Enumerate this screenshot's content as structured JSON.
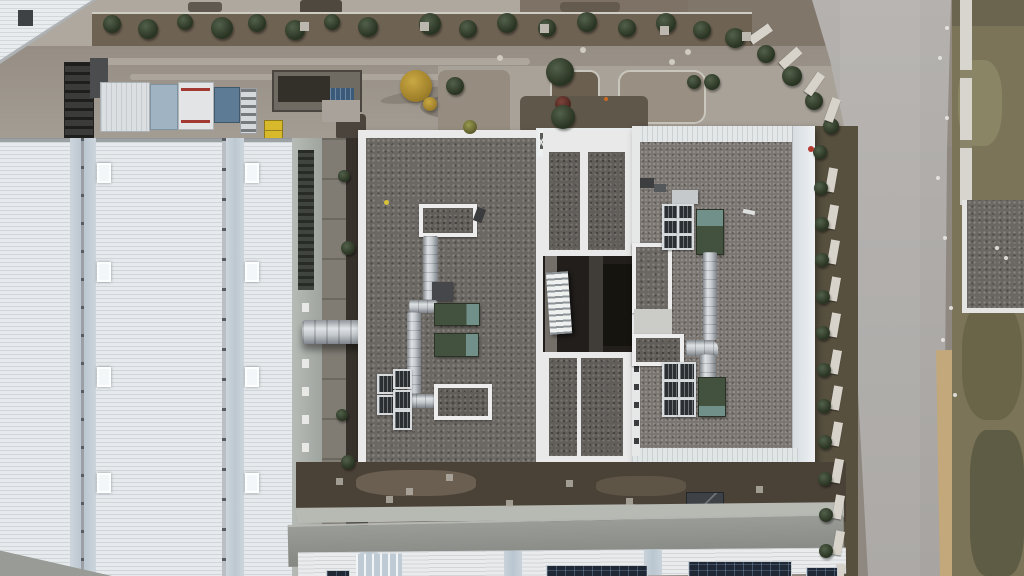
{
  "scene": {
    "type": "aerial-drone-photo",
    "subject": "industrial facility rooftops with flat gravel roof, white metal warehouse roofs, HVAC equipment, access roads",
    "palette": {
      "dirt": "#8f8881",
      "gravel": "#6b6763",
      "gravel_light": "#7b7672",
      "roof_white": "#e7eaec",
      "road": "#a8a5a2",
      "grass": "#7b7458",
      "sand": "#c3a87c",
      "green_unit": "#42523f",
      "teal_cap": "#72908a",
      "solar": "#202836",
      "yellow_tree": "#c9a843",
      "courtyard_dark": "#211e1b"
    },
    "items": [
      {
        "cls": "tree",
        "x": 112,
        "y": 24,
        "r": 9
      },
      {
        "cls": "tree",
        "x": 148,
        "y": 29,
        "r": 10
      },
      {
        "cls": "tree",
        "x": 185,
        "y": 22,
        "r": 8
      },
      {
        "cls": "tree",
        "x": 222,
        "y": 28,
        "r": 11
      },
      {
        "cls": "tree",
        "x": 257,
        "y": 23,
        "r": 9
      },
      {
        "cls": "tree",
        "x": 295,
        "y": 30,
        "r": 10
      },
      {
        "cls": "tree",
        "x": 332,
        "y": 22,
        "r": 8
      },
      {
        "cls": "tree",
        "x": 368,
        "y": 27,
        "r": 10
      },
      {
        "cls": "tree",
        "x": 430,
        "y": 24,
        "r": 11
      },
      {
        "cls": "tree",
        "x": 468,
        "y": 29,
        "r": 9
      },
      {
        "cls": "tree",
        "x": 507,
        "y": 23,
        "r": 10
      },
      {
        "cls": "tree",
        "x": 547,
        "y": 28,
        "r": 9
      },
      {
        "cls": "tree",
        "x": 587,
        "y": 22,
        "r": 10
      },
      {
        "cls": "tree",
        "x": 627,
        "y": 28,
        "r": 9
      },
      {
        "cls": "tree",
        "x": 666,
        "y": 23,
        "r": 10
      },
      {
        "cls": "tree",
        "x": 702,
        "y": 30,
        "r": 9
      },
      {
        "cls": "tree",
        "x": 735,
        "y": 38,
        "r": 10
      },
      {
        "cls": "tree",
        "x": 766,
        "y": 54,
        "r": 9
      },
      {
        "cls": "tree",
        "x": 792,
        "y": 76,
        "r": 10
      },
      {
        "cls": "tree",
        "x": 814,
        "y": 101,
        "r": 9
      },
      {
        "cls": "tree",
        "x": 831,
        "y": 126,
        "r": 8
      },
      {
        "cls": "wallseg",
        "x": 756,
        "y": 22,
        "w": 9,
        "h": 24,
        "rot": 55
      },
      {
        "cls": "wallseg",
        "x": 786,
        "y": 46,
        "w": 9,
        "h": 24,
        "rot": 48
      },
      {
        "cls": "wallseg",
        "x": 810,
        "y": 72,
        "w": 9,
        "h": 24,
        "rot": 35
      },
      {
        "cls": "wallseg",
        "x": 828,
        "y": 98,
        "w": 9,
        "h": 24,
        "rot": 20
      },
      {
        "cls": "tree",
        "x": 820,
        "y": 152,
        "r": 7
      },
      {
        "cls": "wallseg",
        "x": 827,
        "y": 168,
        "w": 9,
        "h": 24,
        "rot": 10
      },
      {
        "cls": "tree",
        "x": 821,
        "y": 188,
        "r": 7
      },
      {
        "cls": "wallseg",
        "x": 828,
        "y": 205,
        "w": 9,
        "h": 24,
        "rot": 10
      },
      {
        "cls": "tree",
        "x": 822,
        "y": 224,
        "r": 7
      },
      {
        "cls": "wallseg",
        "x": 829,
        "y": 240,
        "w": 9,
        "h": 24,
        "rot": 10
      },
      {
        "cls": "tree",
        "x": 822,
        "y": 260,
        "r": 7
      },
      {
        "cls": "wallseg",
        "x": 830,
        "y": 277,
        "w": 9,
        "h": 24,
        "rot": 10
      },
      {
        "cls": "tree",
        "x": 823,
        "y": 297,
        "r": 7
      },
      {
        "cls": "wallseg",
        "x": 830,
        "y": 313,
        "w": 9,
        "h": 24,
        "rot": 10
      },
      {
        "cls": "tree",
        "x": 823,
        "y": 333,
        "r": 7
      },
      {
        "cls": "wallseg",
        "x": 831,
        "y": 350,
        "w": 9,
        "h": 24,
        "rot": 10
      },
      {
        "cls": "tree",
        "x": 824,
        "y": 370,
        "r": 7
      },
      {
        "cls": "wallseg",
        "x": 832,
        "y": 386,
        "w": 9,
        "h": 24,
        "rot": 10
      },
      {
        "cls": "tree",
        "x": 824,
        "y": 406,
        "r": 7
      },
      {
        "cls": "wallseg",
        "x": 832,
        "y": 422,
        "w": 9,
        "h": 24,
        "rot": 10
      },
      {
        "cls": "tree",
        "x": 825,
        "y": 442,
        "r": 7
      },
      {
        "cls": "wallseg",
        "x": 833,
        "y": 459,
        "w": 9,
        "h": 24,
        "rot": 10
      },
      {
        "cls": "tree",
        "x": 825,
        "y": 479,
        "r": 7
      },
      {
        "cls": "wallseg",
        "x": 834,
        "y": 495,
        "w": 9,
        "h": 24,
        "rot": 10
      },
      {
        "cls": "tree",
        "x": 826,
        "y": 515,
        "r": 7
      },
      {
        "cls": "wallseg",
        "x": 834,
        "y": 531,
        "w": 9,
        "h": 24,
        "rot": 10
      },
      {
        "cls": "tree",
        "x": 826,
        "y": 551,
        "r": 7
      },
      {
        "cls": "wallseg",
        "x": 835,
        "y": 564,
        "w": 9,
        "h": 22,
        "rot": 10
      },
      {
        "cls": "skylight",
        "x": 97,
        "y": 163,
        "w": 10,
        "h": 16
      },
      {
        "cls": "skylight",
        "x": 245,
        "y": 163,
        "w": 10,
        "h": 16
      },
      {
        "cls": "skylight",
        "x": 97,
        "y": 262,
        "w": 10,
        "h": 16
      },
      {
        "cls": "skylight",
        "x": 245,
        "y": 262,
        "w": 10,
        "h": 16
      },
      {
        "cls": "skylight",
        "x": 97,
        "y": 367,
        "w": 10,
        "h": 16
      },
      {
        "cls": "skylight",
        "x": 245,
        "y": 367,
        "w": 10,
        "h": 16
      },
      {
        "cls": "skylight",
        "x": 97,
        "y": 473,
        "w": 10,
        "h": 16
      },
      {
        "cls": "skylight",
        "x": 245,
        "y": 473,
        "w": 10,
        "h": 16
      },
      {
        "cls": "solar",
        "x": 326,
        "y": 570,
        "w": 22,
        "h": 6
      },
      {
        "cls": "solar",
        "x": 546,
        "y": 565,
        "w": 100,
        "h": 11
      },
      {
        "cls": "solar",
        "x": 688,
        "y": 561,
        "w": 102,
        "h": 15
      },
      {
        "cls": "solar",
        "x": 806,
        "y": 567,
        "w": 30,
        "h": 9
      },
      {
        "cls": "grate",
        "x": 377,
        "y": 374,
        "w": 15,
        "h": 16
      },
      {
        "cls": "grate",
        "x": 377,
        "y": 395,
        "w": 15,
        "h": 16
      },
      {
        "cls": "grate",
        "x": 393,
        "y": 369,
        "w": 15,
        "h": 16
      },
      {
        "cls": "grate",
        "x": 393,
        "y": 390,
        "w": 15,
        "h": 16
      },
      {
        "cls": "grate",
        "x": 393,
        "y": 410,
        "w": 15,
        "h": 16
      },
      {
        "cls": "grate",
        "x": 662,
        "y": 204,
        "w": 13,
        "h": 12
      },
      {
        "cls": "grate",
        "x": 677,
        "y": 204,
        "w": 13,
        "h": 12
      },
      {
        "cls": "grate",
        "x": 662,
        "y": 219,
        "w": 13,
        "h": 12
      },
      {
        "cls": "grate",
        "x": 677,
        "y": 219,
        "w": 13,
        "h": 12
      },
      {
        "cls": "grate",
        "x": 662,
        "y": 234,
        "w": 13,
        "h": 12
      },
      {
        "cls": "grate",
        "x": 677,
        "y": 234,
        "w": 13,
        "h": 12
      },
      {
        "cls": "grate",
        "x": 662,
        "y": 362,
        "w": 14,
        "h": 15
      },
      {
        "cls": "grate",
        "x": 678,
        "y": 362,
        "w": 14,
        "h": 15
      },
      {
        "cls": "grate",
        "x": 662,
        "y": 380,
        "w": 14,
        "h": 15
      },
      {
        "cls": "grate",
        "x": 678,
        "y": 380,
        "w": 14,
        "h": 15
      },
      {
        "cls": "grate",
        "x": 662,
        "y": 398,
        "w": 14,
        "h": 15
      },
      {
        "cls": "grate",
        "x": 678,
        "y": 398,
        "w": 14,
        "h": 15
      },
      {
        "cls": "pad",
        "x": 300,
        "y": 22,
        "w": 9,
        "h": 9
      },
      {
        "cls": "pad",
        "x": 420,
        "y": 22,
        "w": 9,
        "h": 9
      },
      {
        "cls": "pad",
        "x": 540,
        "y": 24,
        "w": 9,
        "h": 9
      },
      {
        "cls": "pad",
        "x": 660,
        "y": 26,
        "w": 9,
        "h": 9
      },
      {
        "cls": "pad",
        "x": 742,
        "y": 32,
        "w": 9,
        "h": 9
      },
      {
        "cls": "gpad",
        "x": 336,
        "y": 478,
        "w": 7,
        "h": 7
      },
      {
        "cls": "gpad",
        "x": 386,
        "y": 496,
        "w": 7,
        "h": 7
      },
      {
        "cls": "gpad",
        "x": 446,
        "y": 474,
        "w": 7,
        "h": 7
      },
      {
        "cls": "gpad",
        "x": 506,
        "y": 500,
        "w": 7,
        "h": 7
      },
      {
        "cls": "gpad",
        "x": 566,
        "y": 480,
        "w": 7,
        "h": 7
      },
      {
        "cls": "gpad",
        "x": 626,
        "y": 498,
        "w": 7,
        "h": 7
      },
      {
        "cls": "gpad",
        "x": 406,
        "y": 488,
        "w": 7,
        "h": 7
      },
      {
        "cls": "gpad",
        "x": 756,
        "y": 486,
        "w": 7,
        "h": 7
      },
      {
        "cls": "mdot",
        "x": 583,
        "y": 50,
        "r": 3
      },
      {
        "cls": "mdot",
        "x": 672,
        "y": 62,
        "r": 3
      },
      {
        "cls": "mdot",
        "x": 688,
        "y": 52,
        "r": 3
      },
      {
        "cls": "mdot",
        "x": 500,
        "y": 58,
        "r": 3
      },
      {
        "cls": "cone",
        "x": 606,
        "y": 99,
        "r": 2
      },
      {
        "cls": "debris",
        "x": 940,
        "y": 58,
        "r": 2
      },
      {
        "cls": "debris",
        "x": 947,
        "y": 118,
        "r": 2
      },
      {
        "cls": "debris",
        "x": 938,
        "y": 178,
        "r": 2
      },
      {
        "cls": "debris",
        "x": 945,
        "y": 238,
        "r": 2
      },
      {
        "cls": "debris",
        "x": 951,
        "y": 308,
        "r": 2
      },
      {
        "cls": "debris",
        "x": 947,
        "y": 28,
        "r": 2
      },
      {
        "cls": "debris",
        "x": 997,
        "y": 248,
        "r": 2
      },
      {
        "cls": "debris",
        "x": 1006,
        "y": 258,
        "r": 2
      },
      {
        "cls": "debris",
        "x": 943,
        "y": 340,
        "r": 2
      },
      {
        "cls": "debris",
        "x": 955,
        "y": 395,
        "r": 2
      },
      {
        "cls": "tree",
        "x": 455,
        "y": 86,
        "r": 9
      },
      {
        "cls": "tree",
        "x": 712,
        "y": 82,
        "r": 8
      },
      {
        "cls": "tree",
        "x": 694,
        "y": 82,
        "r": 7
      },
      {
        "cls": "tree-olive",
        "x": 470,
        "y": 127,
        "r": 7
      },
      {
        "cls": "tree",
        "x": 560,
        "y": 72,
        "r": 14
      },
      {
        "cls": "tree-red",
        "x": 563,
        "y": 104,
        "r": 8
      },
      {
        "cls": "tree-yellow",
        "x": 416,
        "y": 86,
        "r": 16
      },
      {
        "cls": "tree-yellow",
        "x": 430,
        "y": 104,
        "r": 7
      },
      {
        "cls": "tree",
        "x": 563,
        "y": 117,
        "r": 12
      },
      {
        "cls": "tree",
        "x": 344,
        "y": 176,
        "r": 6
      },
      {
        "cls": "tree",
        "x": 348,
        "y": 248,
        "r": 7
      },
      {
        "cls": "tree",
        "x": 342,
        "y": 415,
        "r": 6
      },
      {
        "cls": "tree",
        "x": 348,
        "y": 462,
        "r": 7
      },
      {
        "cls": "rdot",
        "x": 811,
        "y": 149,
        "r": 3
      }
    ]
  }
}
